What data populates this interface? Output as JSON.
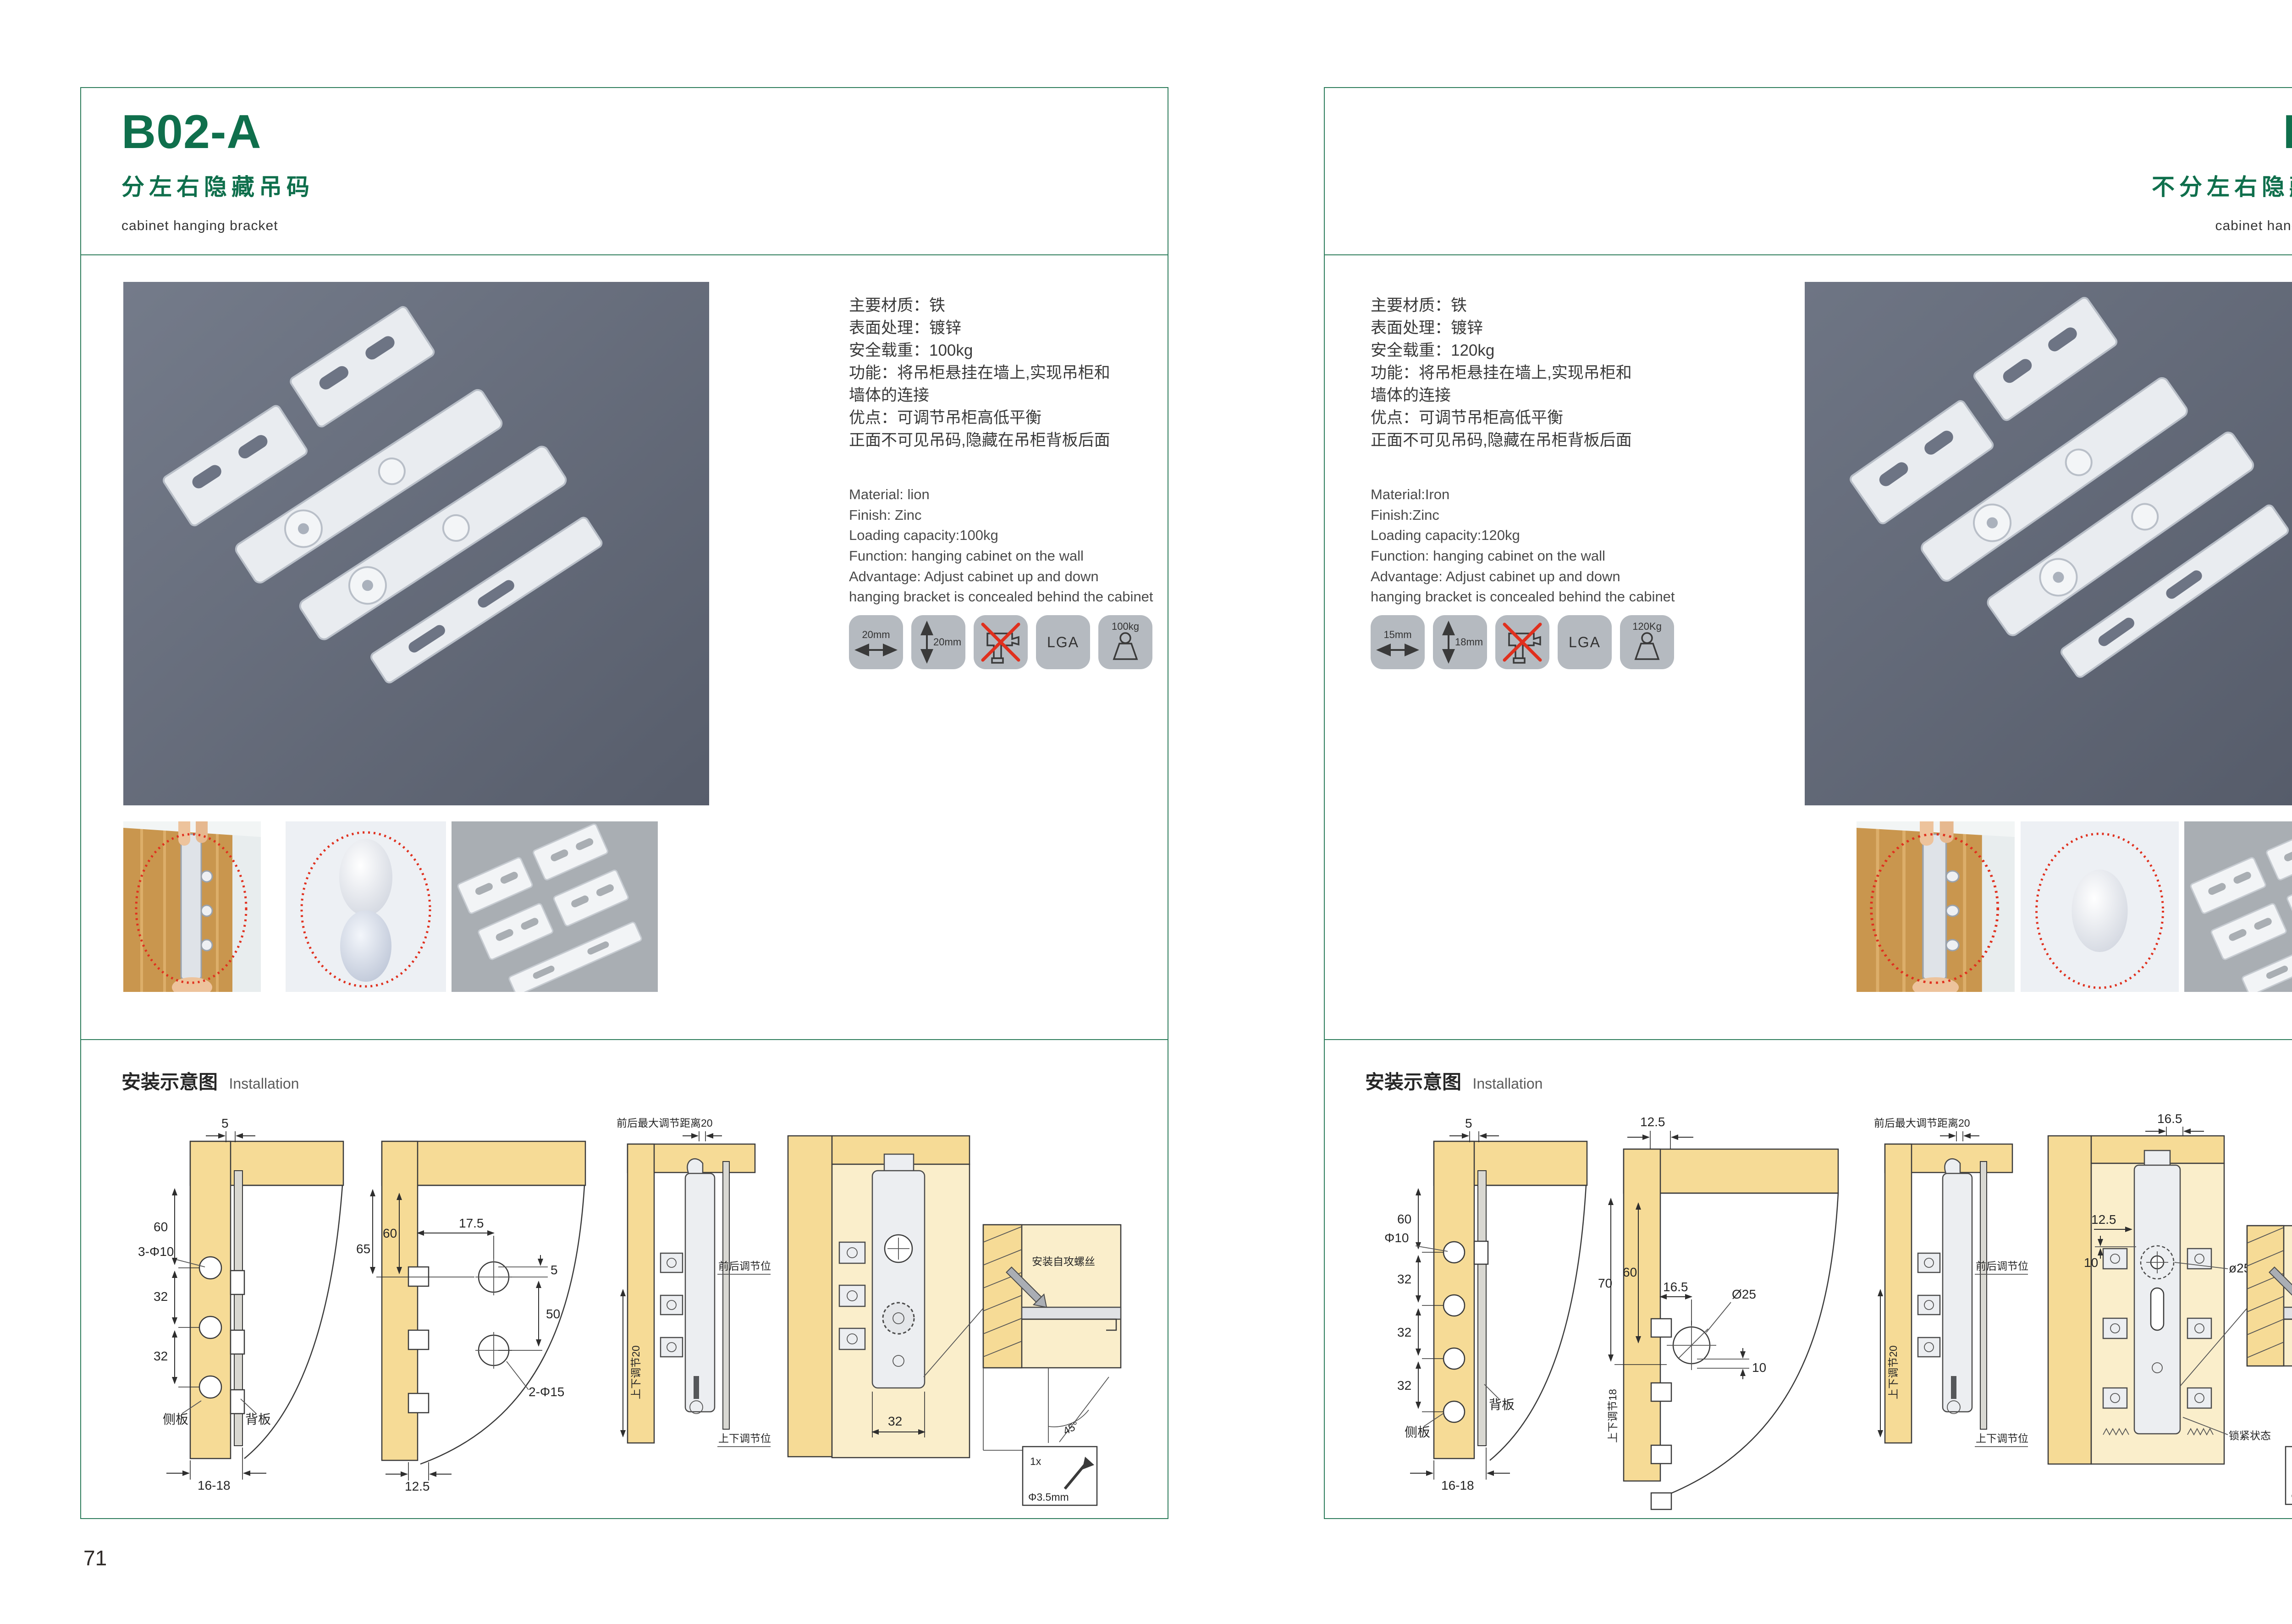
{
  "installation_section": {
    "title_cn": "安装示意图",
    "title_en": "Installation"
  },
  "accent": {
    "green": "#0f6f4c",
    "border_green": "#2e7d5c",
    "red": "#e0301e"
  },
  "pages": [
    {
      "code": "B02-A",
      "name_cn": "分左右隐藏吊码",
      "name_en": "cabinet hanging bracket",
      "page_number": "71",
      "specs_cn": [
        "主要材质：铁",
        "表面处理：镀锌",
        "安全载重：100kg",
        "功能：将吊柜悬挂在墙上,实现吊柜和",
        "墙体的连接",
        "优点：可调节吊柜高低平衡",
        "正面不可见吊码,隐藏在吊柜背板后面"
      ],
      "specs_en": [
        "Material: lion",
        "Finish: Zinc",
        "Loading capacity:100kg",
        "Function: hanging cabinet on the wall",
        "Advantage: Adjust cabinet up and down",
        "hanging bracket is concealed behind the cabinet"
      ],
      "spec_icons": [
        {
          "name": "width-arrow-icon",
          "label": "20mm"
        },
        {
          "name": "height-arrow-icon",
          "label": "20mm"
        },
        {
          "name": "no-drill-icon",
          "label": ""
        },
        {
          "name": "lga-cert-icon",
          "label": "LGA"
        },
        {
          "name": "load-weight-icon",
          "label": "100kg"
        }
      ],
      "diagrams": {
        "d1": {
          "dim_top": "5",
          "dim_a": "60",
          "hole": "3-Φ10",
          "dim_b": "32",
          "dim_c": "32",
          "side": "侧板",
          "back": "背板",
          "dim_bottom": "16-18"
        },
        "d2": {
          "dim_w": "17.5",
          "dim_a": "65",
          "dim_b": "60",
          "dim_s": "5",
          "dim_c": "50",
          "hole": "2-Φ15",
          "dim_bottom": "12.5"
        },
        "d3": {
          "top": "前后最大调节距离20",
          "vert": "上下调节20",
          "fb": "前后调节位",
          "ud": "上下调节位"
        },
        "d4": {
          "dim": "32",
          "note": "安装自攻螺丝",
          "angle": "45°",
          "qty": "1x",
          "dia": "Φ3.5mm"
        }
      }
    },
    {
      "code": "B03",
      "name_cn": "不分左右隐藏吊码",
      "name_en": "cabinet hanging bracket",
      "page_number": "72",
      "specs_cn": [
        "主要材质：铁",
        "表面处理：镀锌",
        "安全载重：120kg",
        "功能：将吊柜悬挂在墙上,实现吊柜和",
        "墙体的连接",
        "优点：可调节吊柜高低平衡",
        "正面不可见吊码,隐藏在吊柜背板后面"
      ],
      "specs_en": [
        "Material:Iron",
        "Finish:Zinc",
        "Loading capacity:120kg",
        "Function: hanging cabinet on the wall",
        "Advantage: Adjust cabinet up and down",
        "hanging bracket is concealed behind the cabinet"
      ],
      "spec_icons": [
        {
          "name": "width-arrow-icon",
          "label": "15mm"
        },
        {
          "name": "height-arrow-icon",
          "label": "18mm"
        },
        {
          "name": "no-drill-icon",
          "label": ""
        },
        {
          "name": "lga-cert-icon",
          "label": "LGA"
        },
        {
          "name": "load-weight-icon",
          "label": "120Kg"
        }
      ],
      "diagrams": {
        "d1": {
          "dim_top": "5",
          "dim_a": "60",
          "hole": "Φ10",
          "dim_b": "32",
          "dim_c": "32",
          "dim_d": "32",
          "side": "侧板",
          "back": "背板",
          "dim_bottom": "16-18"
        },
        "d2": {
          "dim_top": "12.5",
          "dim_a": "70",
          "dim_b": "60",
          "dim_w": "16.5",
          "hole": "Ø25",
          "dim_s": "10",
          "vert": "上下调节18"
        },
        "d3": {
          "top": "前后最大调节距离20",
          "vert": "上下调节20",
          "fb": "前后调节位",
          "ud": "上下调节位"
        },
        "d4": {
          "dim_top": "16.5",
          "dim_a": "12.5",
          "dim_s": "10",
          "hole": "ø25",
          "lock": "锁紧状态",
          "note": "安装自攻螺丝",
          "angle": "45°",
          "qty": "1x",
          "dia": "Φ3.5mm"
        }
      }
    }
  ]
}
